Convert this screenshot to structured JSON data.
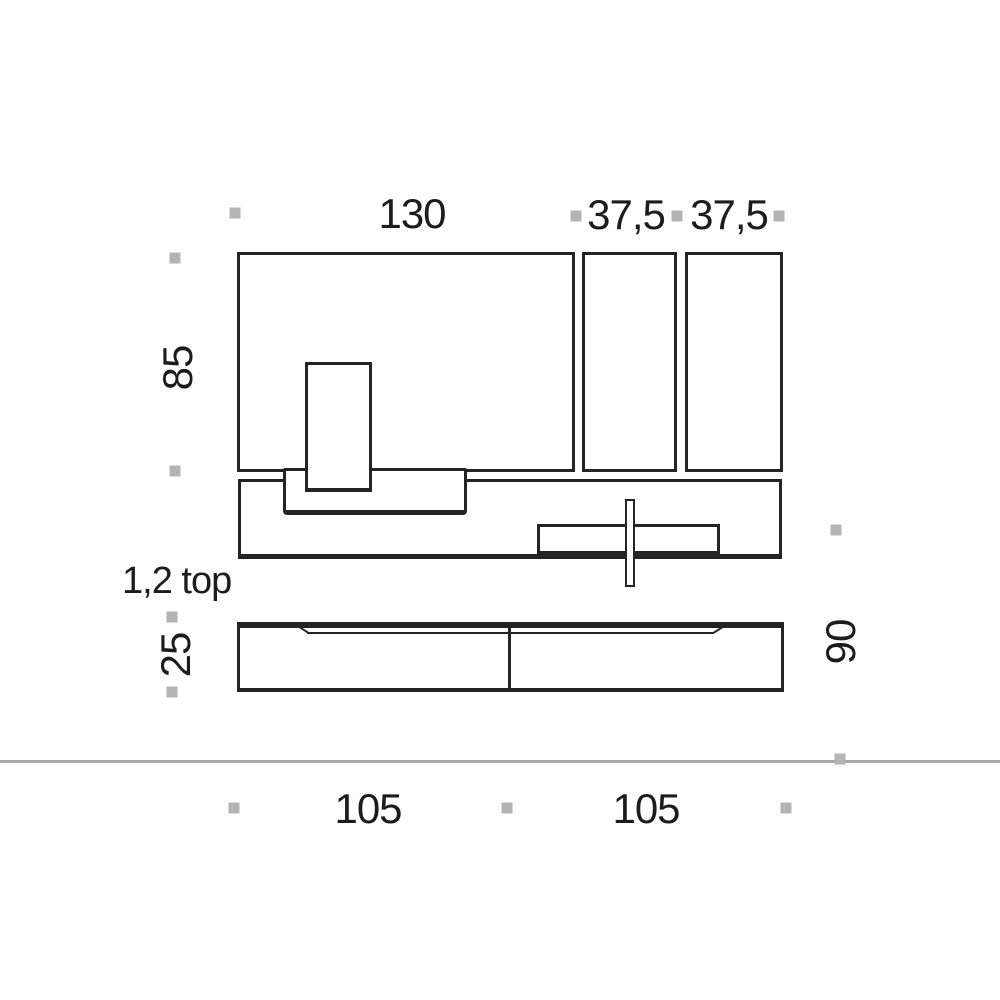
{
  "diagram": {
    "description": "Wall unit furniture dimension drawing",
    "dimensions": {
      "top_width_main": "130",
      "top_width_col1": "37,5",
      "top_width_col2": "37,5",
      "upper_height": "85",
      "thickness_note": "1,2 top",
      "base_height": "25",
      "right_depth": "90",
      "base_width_left": "105",
      "base_width_right": "105"
    },
    "colors": {
      "line": "#242424",
      "text": "#1c1c1c",
      "marker": "#b4b4b4",
      "baseline": "#a8a8a8",
      "background": "#ffffff"
    }
  }
}
